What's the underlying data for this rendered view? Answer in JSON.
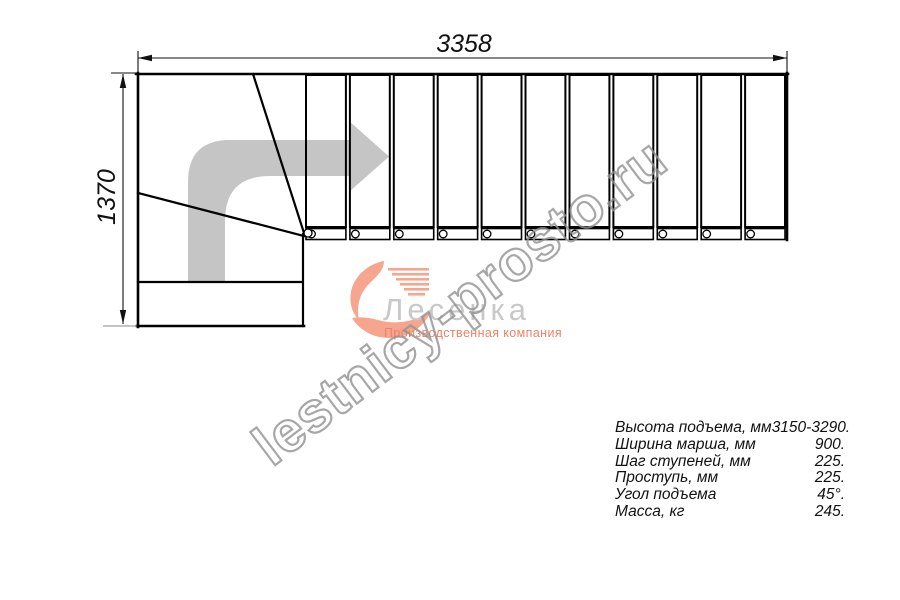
{
  "dimensions": {
    "top_width_mm": "3358",
    "left_height_mm": "1370"
  },
  "watermark": {
    "text": "lestnicy-prosto.ru"
  },
  "logo": {
    "name": "Лесенка",
    "subtitle": "Производственная компания",
    "accent_color": "#f6a68f",
    "name_color": "#c8c8c8",
    "subtitle_color": "#ef8168"
  },
  "specs": {
    "rows": [
      {
        "label": "Высота подъема, мм",
        "value": "3150-3290."
      },
      {
        "label": "Ширина марша, мм",
        "value": "900."
      },
      {
        "label": "Шаг ступеней, мм",
        "value": "225."
      },
      {
        "label": "Проступь, мм",
        "value": "225."
      },
      {
        "label": "Угол подъема",
        "value": "45°."
      },
      {
        "label": "Масса, кг",
        "value": "245."
      }
    ]
  },
  "drawing": {
    "type": "l-shaped-staircase-plan",
    "tread_count": 11,
    "flight": {
      "x1": 304,
      "x2": 787,
      "y_top": 75,
      "y_bottom": 227
    },
    "stringer": {
      "y_top": 228,
      "y_bottom": 240
    },
    "baluster_radius": 3.8,
    "line_color": "#000000",
    "direction_arrow_color": "#c5c5c5"
  }
}
